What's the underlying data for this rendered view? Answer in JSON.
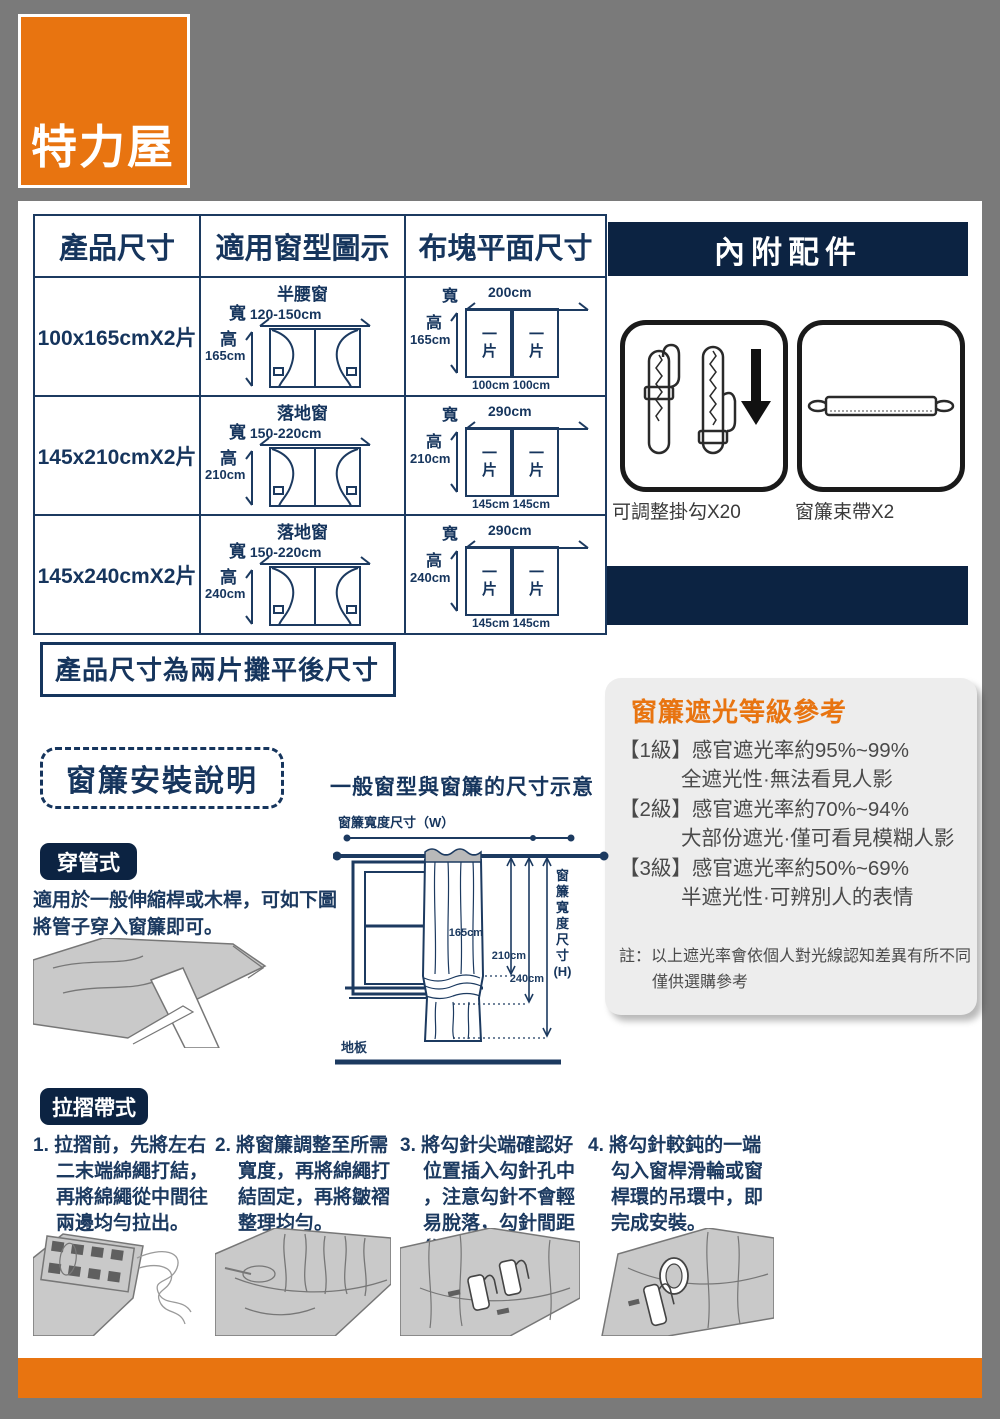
{
  "colors": {
    "page_bg": "#7a7a7a",
    "navy_band": "#0c2342",
    "navy_text": "#1c3a60",
    "orange": "#e87410",
    "box_gray": "#ededed"
  },
  "logo": {
    "brand": "特力屋"
  },
  "spec_table": {
    "headers": [
      "產品尺寸",
      "適用窗型圖示",
      "布塊平面尺寸"
    ],
    "labels": {
      "width": "寬",
      "height": "高"
    },
    "rows": [
      {
        "product_size": "100x165cmX2片",
        "window_name": "半腰窗",
        "window_width": "120-150cm",
        "window_height": "165cm",
        "flat_width": "200cm",
        "flat_height": "165cm",
        "piece": "一片",
        "piece_widths": "100cm 100cm"
      },
      {
        "product_size": "145x210cmX2片",
        "window_name": "落地窗",
        "window_width": "150-220cm",
        "window_height": "210cm",
        "flat_width": "290cm",
        "flat_height": "210cm",
        "piece": "一片",
        "piece_widths": "145cm 145cm"
      },
      {
        "product_size": "145x240cmX2片",
        "window_name": "落地窗",
        "window_width": "150-220cm",
        "window_height": "240cm",
        "flat_width": "290cm",
        "flat_height": "240cm",
        "piece": "一片",
        "piece_widths": "145cm 145cm"
      }
    ]
  },
  "accessories": {
    "title": "內附配件",
    "items": [
      {
        "label": "可調整掛勾X20"
      },
      {
        "label": "窗簾束帶X2"
      }
    ]
  },
  "flat_note": "產品尺寸為兩片攤平後尺寸",
  "install": {
    "title": "窗簾安裝說明",
    "diagram_title": "一般窗型與窗簾的尺寸示意",
    "diagram": {
      "width_label": "窗簾寬度尺寸（W）",
      "height_label": "窗簾寬度尺寸(H)",
      "h1": "165cm",
      "h2": "210cm",
      "h3": "240cm",
      "floor": "地板"
    },
    "rod_pocket": {
      "badge": "穿管式",
      "desc1": "適用於一般伸縮桿或木桿，可如下圖",
      "desc2": "將管子穿入窗簾即可。"
    },
    "pleat": {
      "badge": "拉摺帶式",
      "steps": [
        {
          "lines": [
            "1. 拉摺前，先將左右",
            "二末端綿繩打結，",
            "再將綿繩從中間往",
            "兩邊均勻拉出。"
          ]
        },
        {
          "lines": [
            "2. 將窗簾調整至所需",
            "寬度，再將綿繩打",
            "結固定，再將皺褶",
            "整理均勻。"
          ]
        },
        {
          "lines": [
            "3. 將勾針尖端確認好",
            "位置插入勾針孔中",
            "，注意勾針不會輕",
            "易脫落，勾針間距",
            "約10公分。"
          ]
        },
        {
          "lines": [
            "4. 將勾針較鈍的一端",
            "勾入窗桿滑輪或窗",
            "桿環的吊環中，即",
            "完成安裝。"
          ]
        }
      ]
    }
  },
  "blackout": {
    "title": "窗簾遮光等級參考",
    "levels": [
      {
        "tag": "【1級】",
        "rate": "感官遮光率約95%~99%",
        "desc": "全遮光性·無法看見人影"
      },
      {
        "tag": "【2級】",
        "rate": "感官遮光率約70%~94%",
        "desc": "大部份遮光·僅可看見模糊人影"
      },
      {
        "tag": "【3級】",
        "rate": "感官遮光率約50%~69%",
        "desc": "半遮光性·可辨別人的表情"
      }
    ],
    "note1": "註：以上遮光率會依個人對光線認知差異有所不同",
    "note2": "僅供選購參考"
  }
}
